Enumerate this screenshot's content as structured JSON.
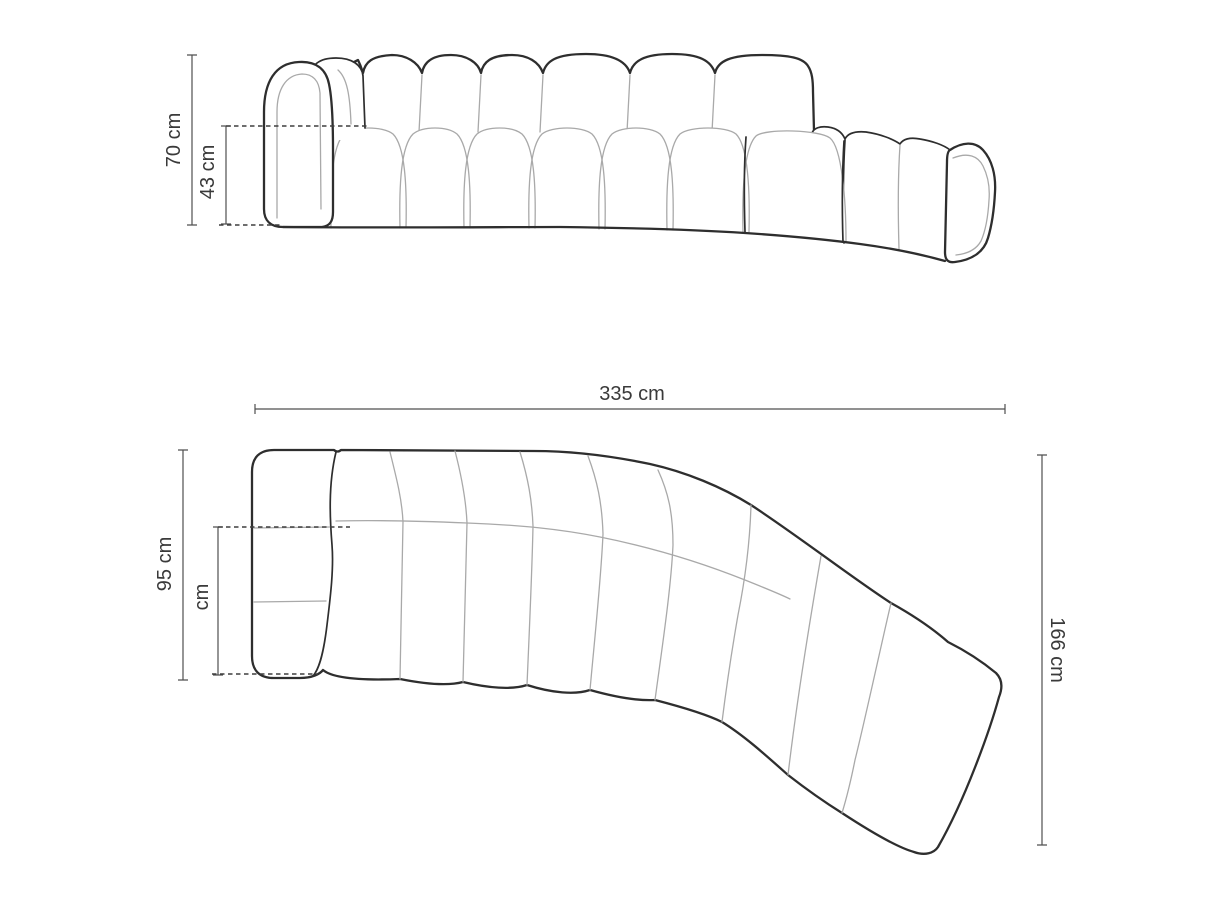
{
  "drawing": {
    "front_view": {
      "total_height": "70 cm",
      "seat_height": "43 cm"
    },
    "top_view": {
      "total_width": "335 cm",
      "left_depth": "95 cm",
      "seat_depth": "cm",
      "right_depth": "166 cm"
    }
  },
  "colors": {
    "outline": "#2e2e2e",
    "seam": "#a9a9a9",
    "dimension_line": "#4f4f4f",
    "label_text": "#3a3a3a",
    "background": "#ffffff"
  }
}
